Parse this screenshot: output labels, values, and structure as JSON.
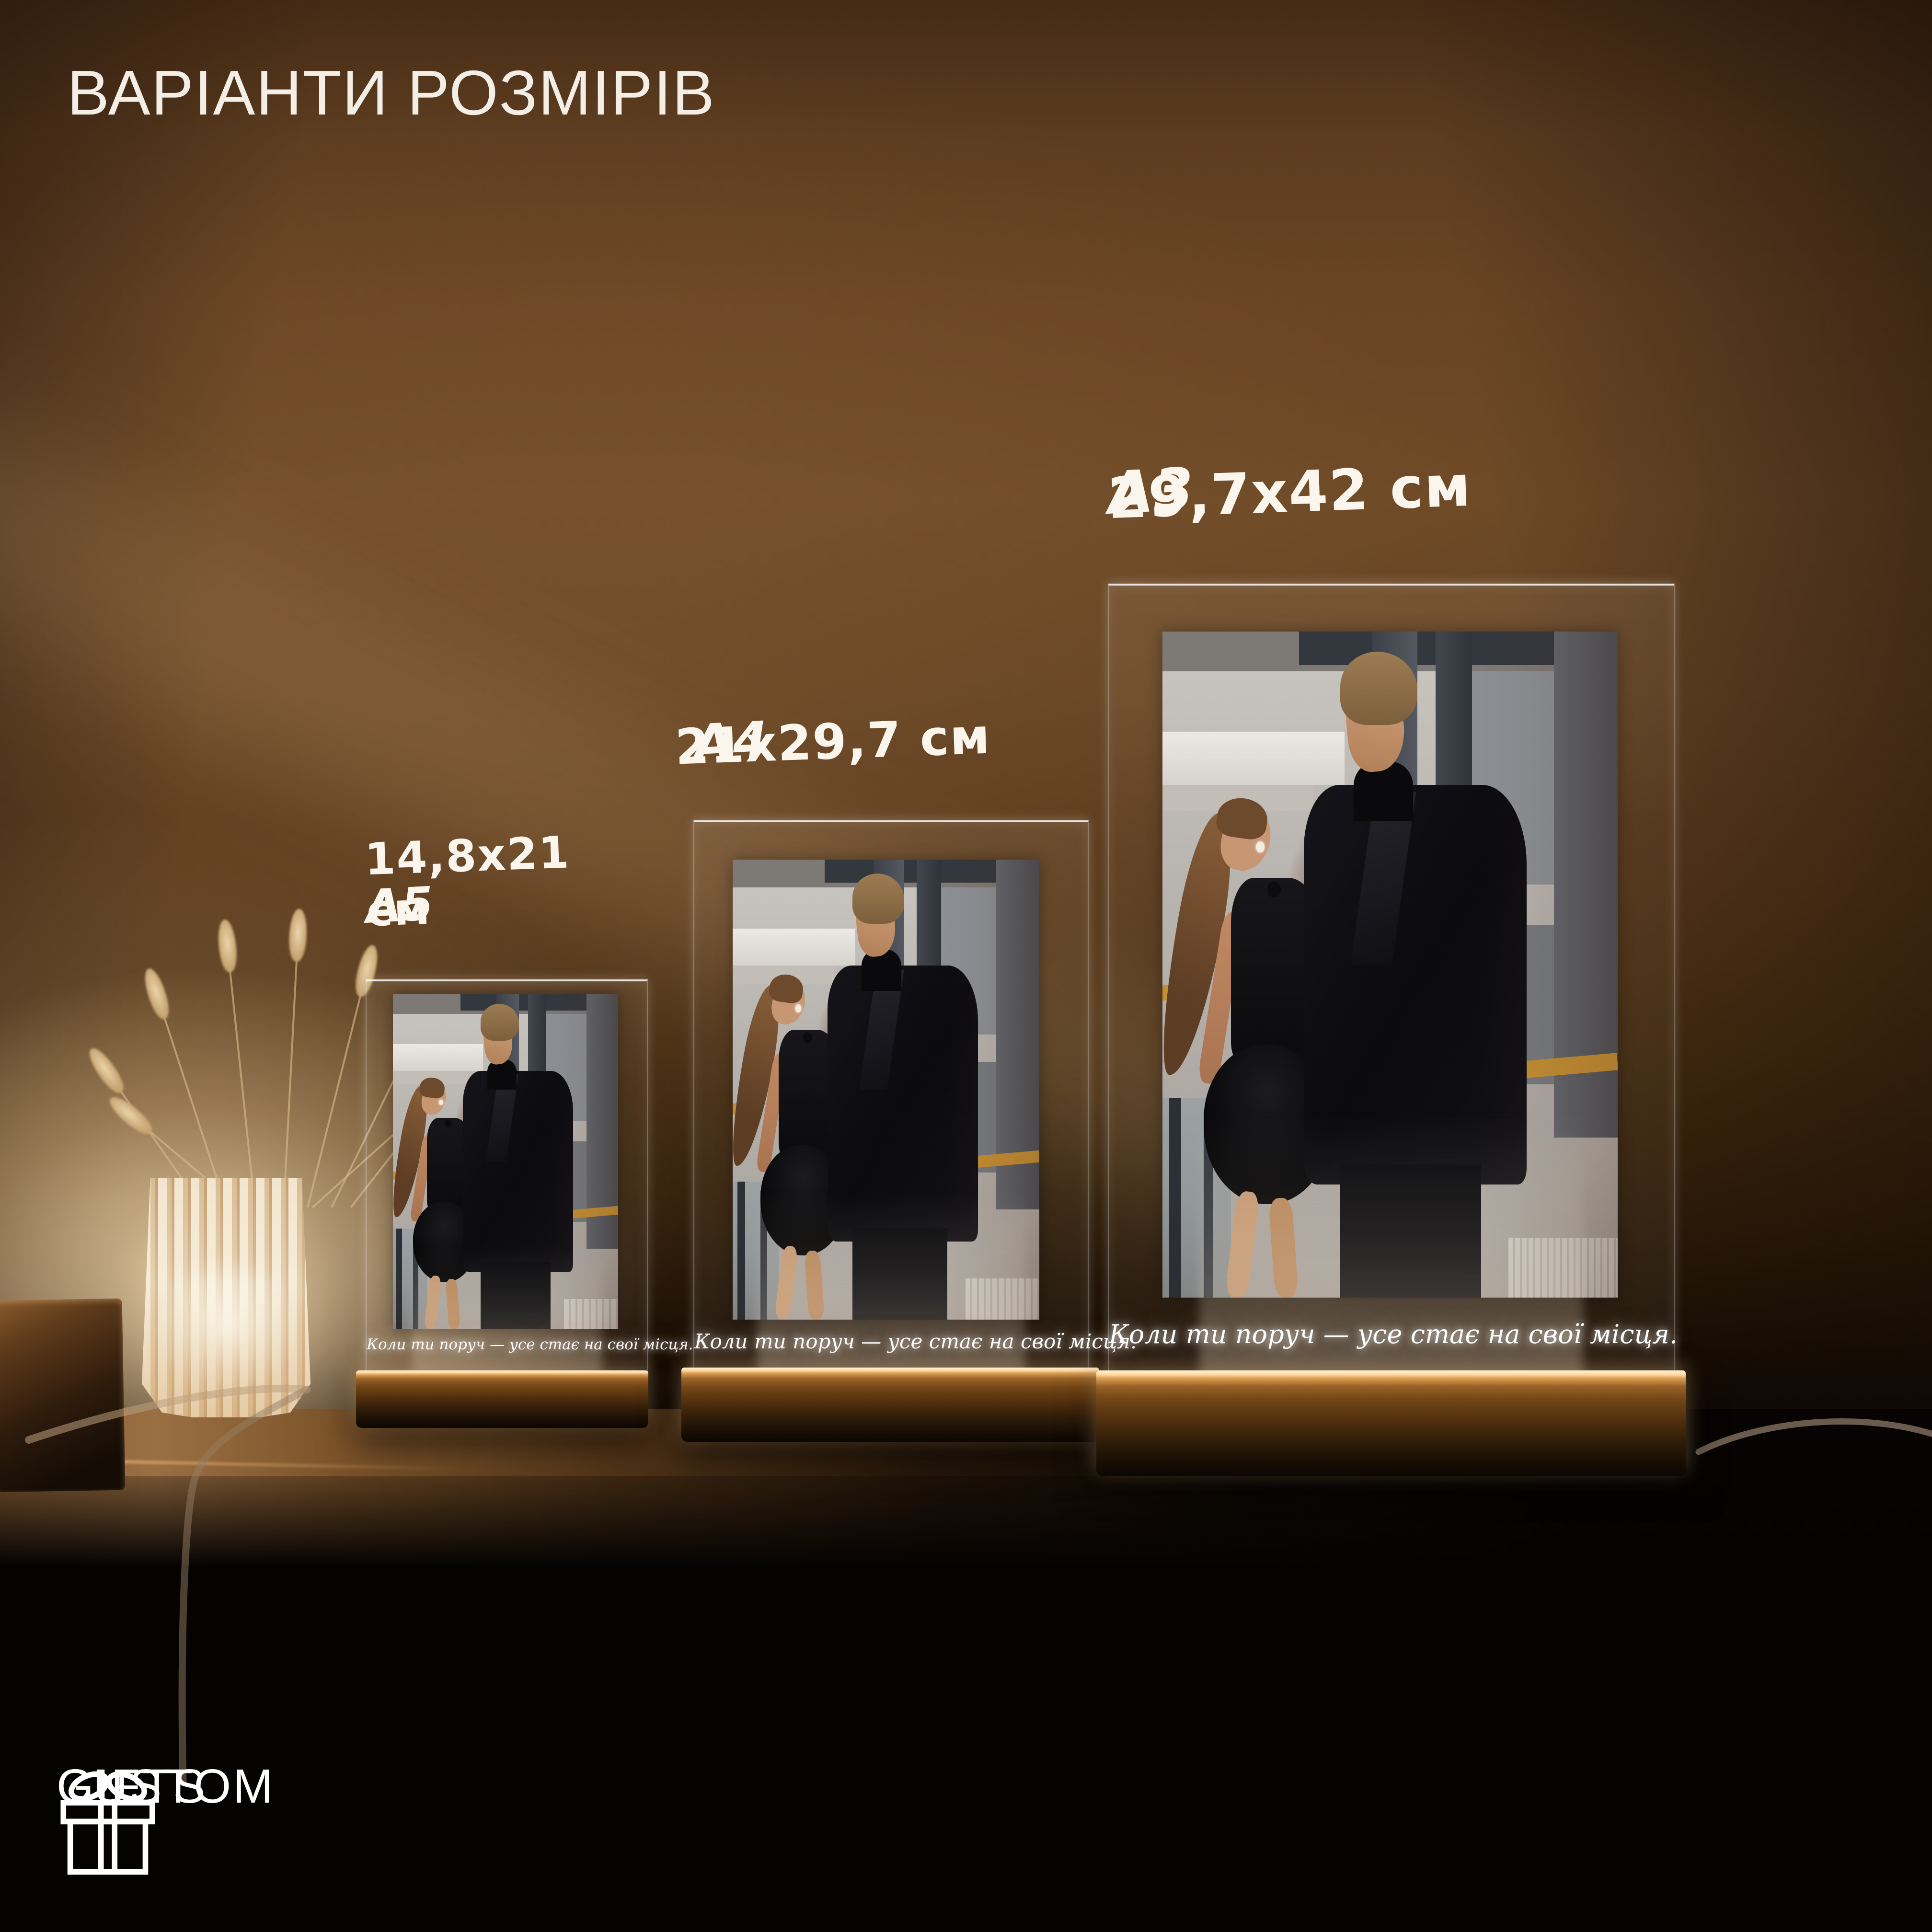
{
  "page": {
    "title": "ВАРІАНТИ РОЗМІРІВ"
  },
  "products": [
    {
      "format": "A5",
      "dimensions": "14,8x21 см",
      "engraving": "Коли ти поруч — усе стає на свої місця."
    },
    {
      "format": "A4",
      "dimensions": "21x29,7 см",
      "engraving": "Коли ти поруч — усе стає на свої місця."
    },
    {
      "format": "A3",
      "dimensions": "29,7x42 см",
      "engraving": "Коли ти поруч — усе стає на свої місця."
    }
  ],
  "brand": {
    "line1": "CUSTOM",
    "line2": "GIFTS",
    "icon": "gift-icon"
  },
  "scene": {
    "objects": [
      "vase-lamp",
      "dried-grass-stems",
      "wooden-block",
      "acrylic-plaque",
      "wooden-base",
      "power-cable"
    ],
    "colors": {
      "wall_brown": "#6b4423",
      "warm_glow": "#ffd9a0",
      "wood_base": "#744716",
      "black_table": "#060302",
      "text_white": "#f5f1ea"
    }
  }
}
